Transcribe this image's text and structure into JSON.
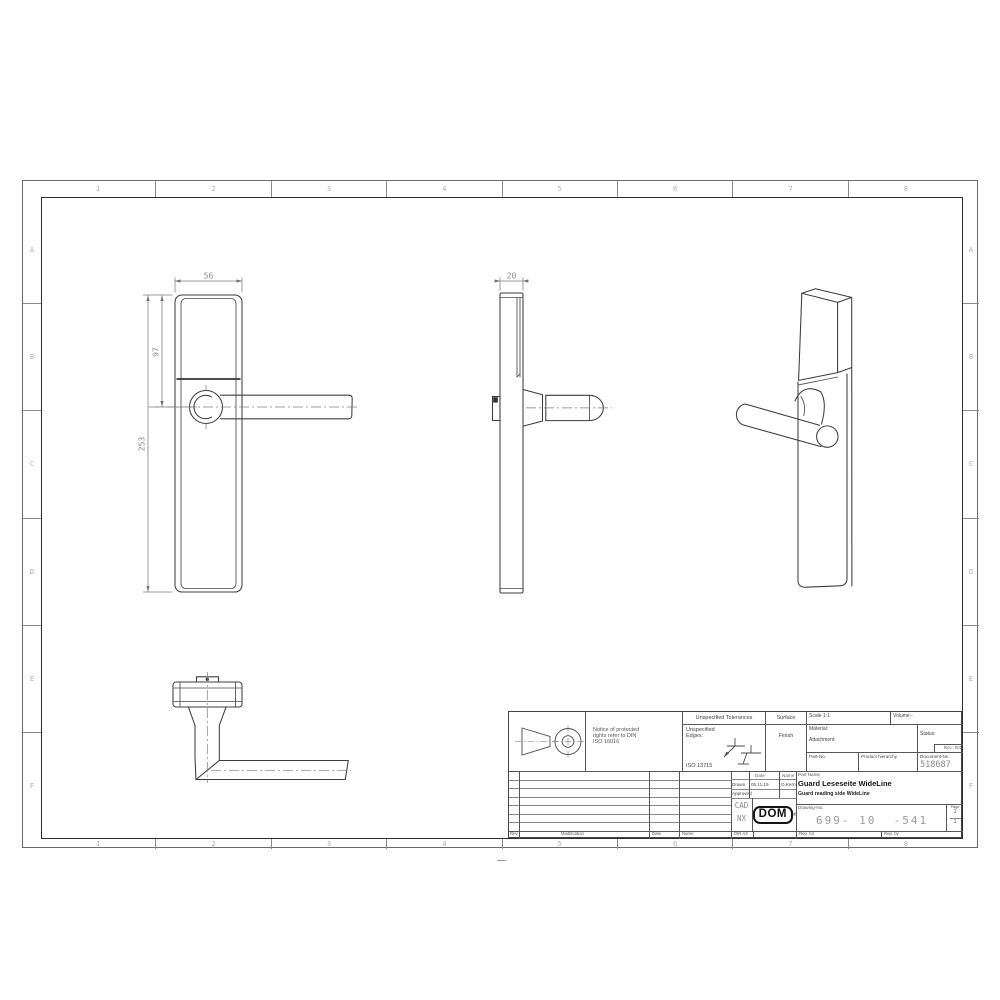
{
  "sheet": {
    "zone_columns": [
      "1",
      "2",
      "3",
      "4",
      "5",
      "6",
      "7",
      "8"
    ],
    "zone_rows": [
      "A",
      "B",
      "C",
      "D",
      "E",
      "F"
    ]
  },
  "dimensions": {
    "front_width": "56",
    "front_handle_height": "97",
    "front_total_height": "253",
    "side_depth": "20"
  },
  "title_block": {
    "notice_line1": "Notice of protected",
    "notice_line2": "rights refer to DIN",
    "notice_line3": "ISO 16016",
    "tolerances_header": "Unspecified Tolerances",
    "edges_line1": "Unspecified",
    "edges_line2": "Edges:",
    "edges_standard": "ISO 13715",
    "surface_header": "Surface",
    "finish_label": "Finish",
    "scale_label": "Scale 1:1",
    "volume_label": "Volume:-",
    "material_label": "Material:",
    "attachment_label": "Attachment:",
    "status_label": "Status:",
    "rev_label": "Rev.: 001",
    "part_no_label": "Part-No.",
    "product_hierarchy_label": "Product hierarchy",
    "document_no_label": "Document-No.",
    "document_no_value": "518687",
    "date_header": "Date",
    "name_header": "Name",
    "drawn_label": "Drawn",
    "drawn_date": "05.11.19",
    "drawn_name": "O.Kern",
    "approved_label": "Approved",
    "cad_line1": "CAD",
    "cad_line2": "NX",
    "logo_text": "DOM",
    "logo_reg": "®",
    "part_name_header": "Part Name",
    "part_name": "Guard Leseseite WideLine",
    "part_name_en": "Guard reading side WideLine",
    "drawing_no_label": "Drawing-No.",
    "drawing_no_value": "699- 10  -541",
    "page_label": "Page",
    "page_num": "1",
    "page_of": "1",
    "footer_rev": "Rev",
    "footer_modification": "Modification",
    "footer_date": "Date",
    "footer_name": "Name",
    "footer_format": "DIN A3",
    "rep_for": "Rep. for",
    "rep_by": "Rep. by"
  }
}
